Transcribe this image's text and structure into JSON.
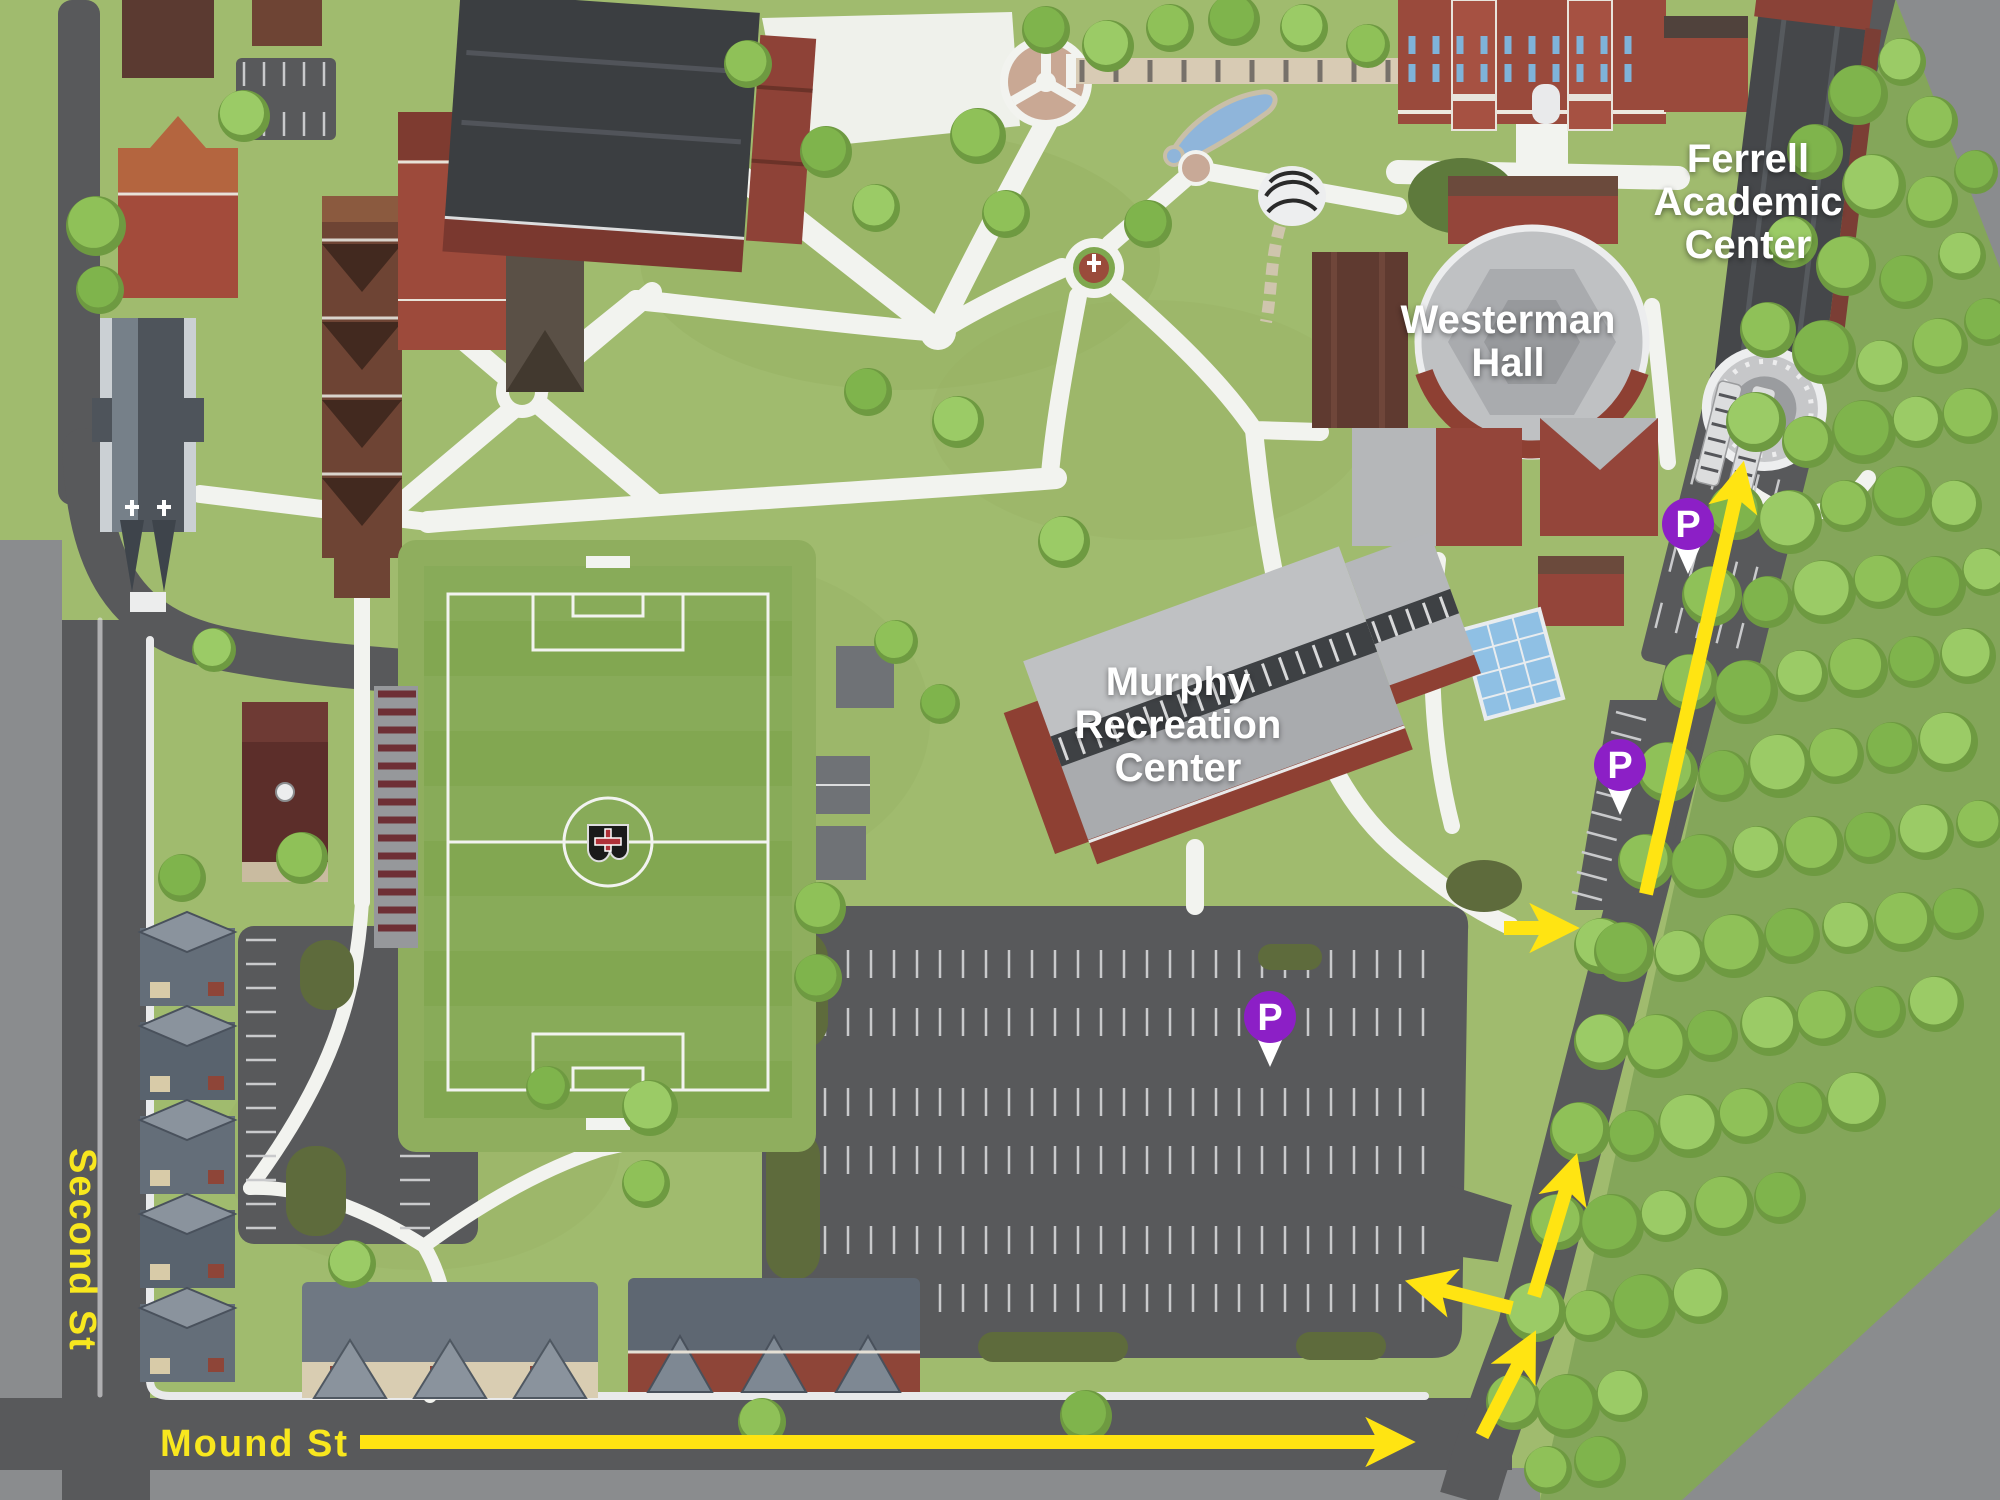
{
  "buildings": [
    {
      "name": "Ferrell Academic Center",
      "label_lines": [
        "Ferrell",
        "Academic",
        "Center"
      ]
    },
    {
      "name": "Westerman Hall",
      "label_lines": [
        "Westerman",
        "Hall"
      ]
    },
    {
      "name": "Murphy Recreation Center",
      "label_lines": [
        "Murphy",
        "Recreation",
        "Center"
      ]
    }
  ],
  "streets": [
    {
      "name": "Second St"
    },
    {
      "name": "Mound St"
    }
  ],
  "parking_pins": [
    {
      "letter": "P"
    },
    {
      "letter": "P"
    },
    {
      "letter": "P"
    }
  ],
  "icons": [
    {
      "name": "parking-pin-icon",
      "glyph": "P",
      "shape": "purple circle pin with white pointer"
    },
    {
      "name": "route-arrow-icon",
      "shape": "yellow directional arrow"
    }
  ],
  "colors": {
    "route_arrow": "#FFE412",
    "street_label": "#F8E71E",
    "parking_pin": "#8C1FC6",
    "building_label": "#FFFFFF",
    "road": "#58595B",
    "off_campus": "#8A8C8E",
    "grass": "#A0BB6E",
    "forest": "#84A65A",
    "tree_foliage": "#8FC158",
    "walkway": "#F2F3EF"
  }
}
